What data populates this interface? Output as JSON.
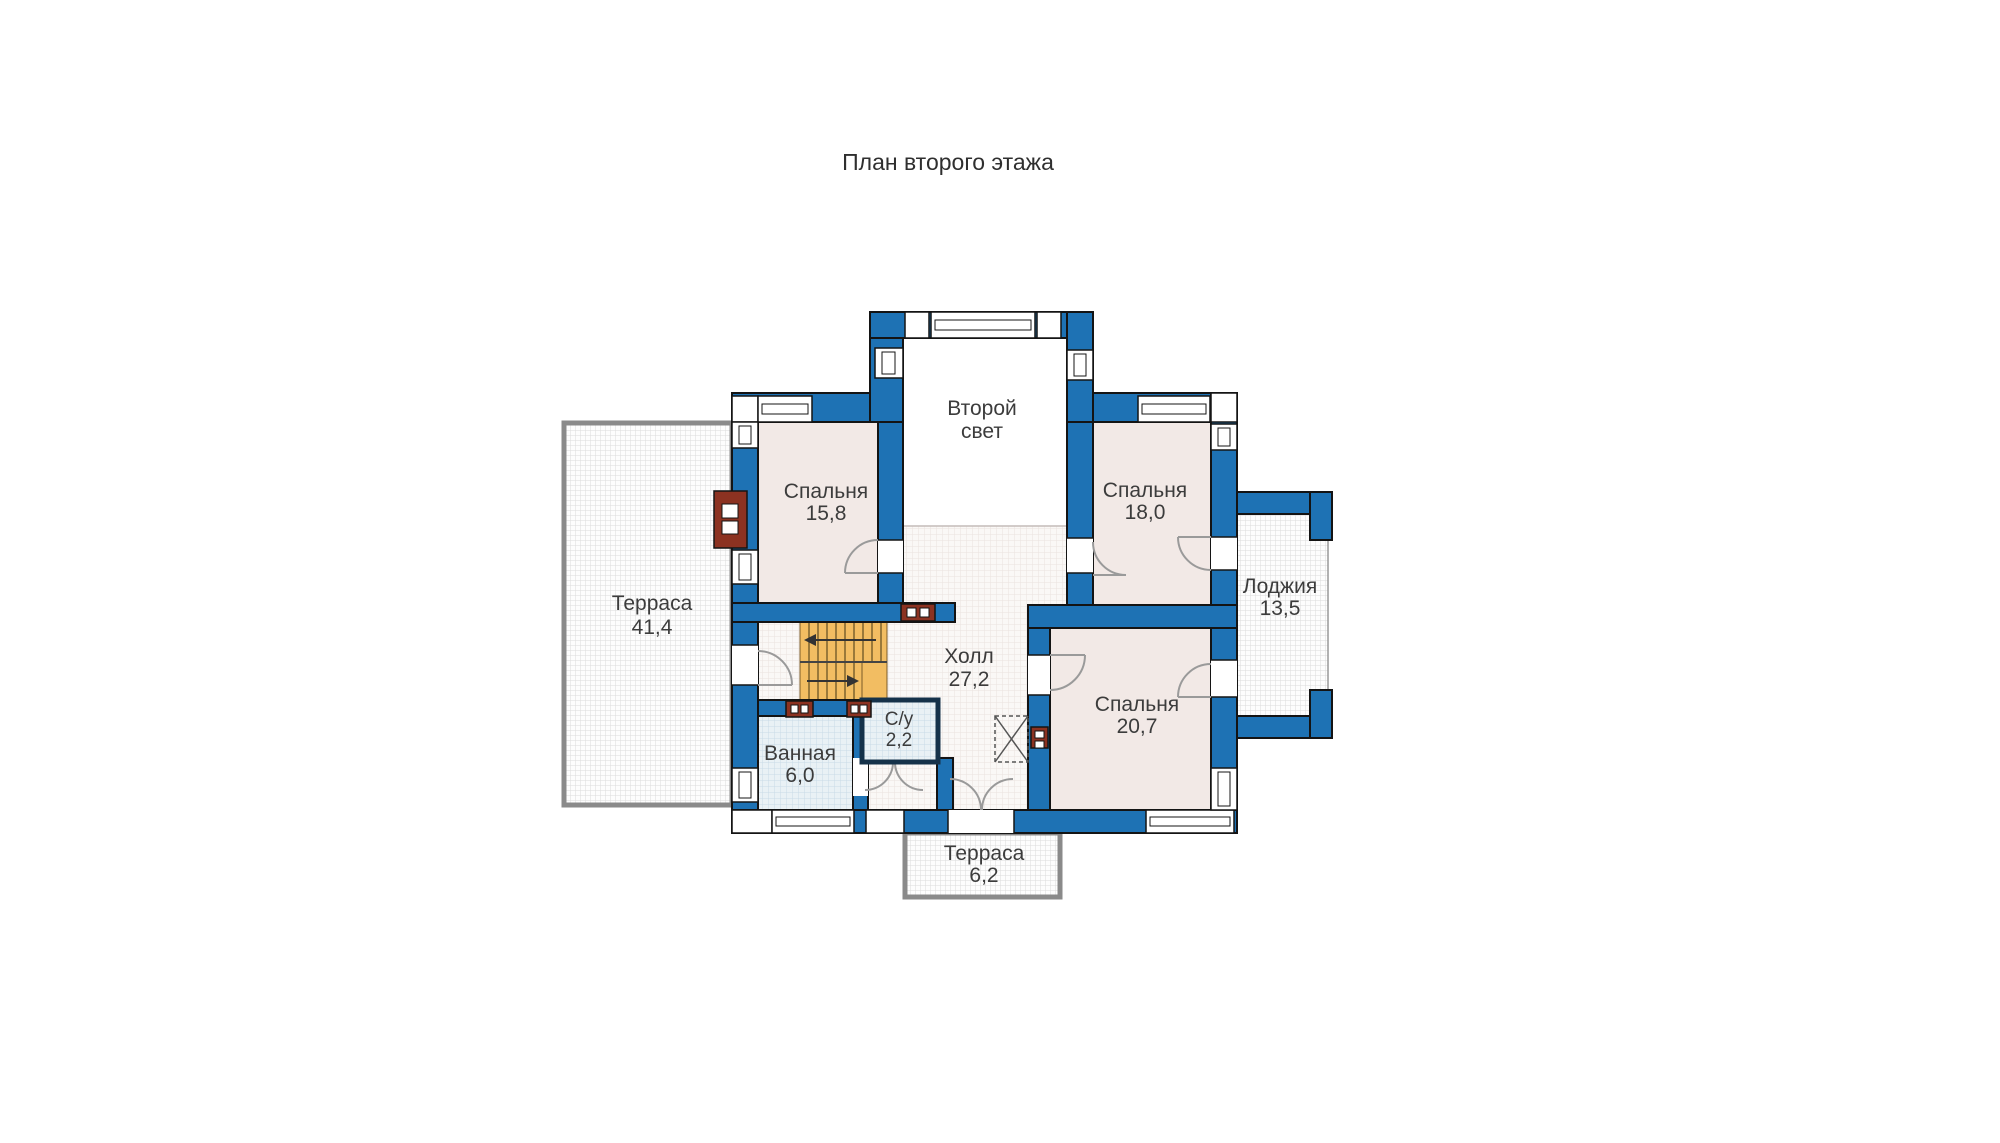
{
  "title": "План второго этажа",
  "plan": {
    "labels": {
      "bedroom1": {
        "line1": "Спальня",
        "line2": "15,8"
      },
      "bedroom2": {
        "line1": "Спальня",
        "line2": "18,0"
      },
      "bedroom3": {
        "line1": "Спальня",
        "line2": "20,7"
      },
      "hall": {
        "line1": "Холл",
        "line2": "27,2"
      },
      "bathroom": {
        "line1": "Ванная",
        "line2": "6,0"
      },
      "wc": {
        "line1": "С/у",
        "line2": "2,2"
      },
      "second_light": {
        "line1": "Второй",
        "line2": "свет"
      },
      "terrace_left": {
        "line1": "Терраса",
        "line2": "41,4"
      },
      "loggia": {
        "line1": "Лоджия",
        "line2": "13,5"
      },
      "terrace_bottom": {
        "line1": "Терраса",
        "line2": "6,2"
      }
    },
    "colors": {
      "wall_blue": "#1E72B4",
      "room_pink": "#F2E9E6",
      "stairs_orange": "#F2BD62",
      "accent_red": "#8C3221",
      "terrace_border_gray": "#8A8A8A",
      "text": "#3C3C3C"
    }
  }
}
